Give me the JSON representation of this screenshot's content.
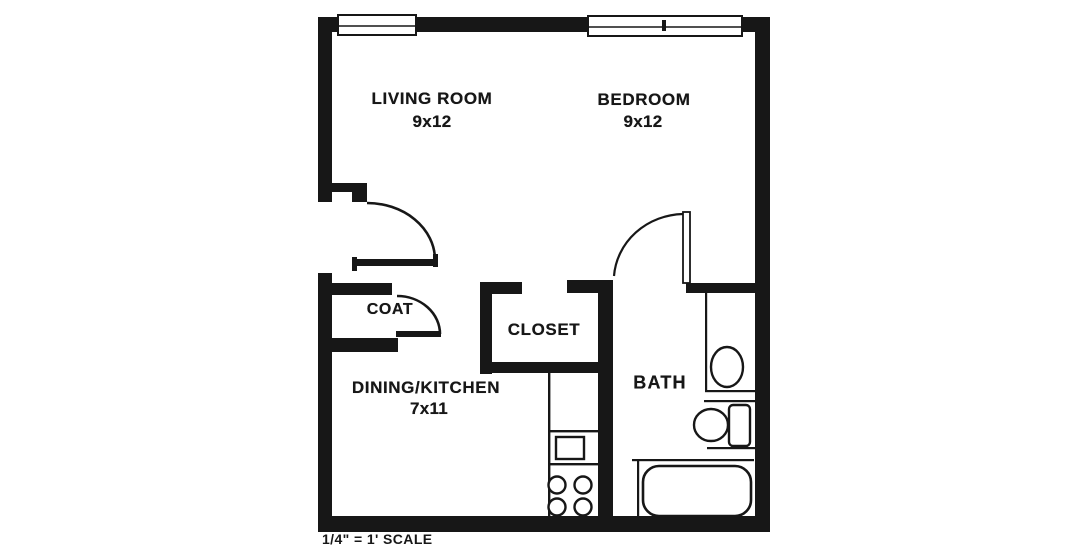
{
  "plan": {
    "type": "apartment-floor-plan",
    "rooms": {
      "living": {
        "name": "LIVING ROOM",
        "dim": "9x12"
      },
      "bedroom": {
        "name": "BEDROOM",
        "dim": "9x12"
      },
      "dining": {
        "name": "DINING/KITCHEN",
        "dim": "7x11"
      },
      "bath": {
        "name": "BATH"
      },
      "coat": {
        "name": "COAT"
      },
      "closet": {
        "name": "CLOSET"
      }
    },
    "scale_note": "1/4\" = 1' SCALE",
    "colors": {
      "ink": "#171717",
      "paper": "#ffffff"
    },
    "fixtures": [
      "window",
      "window-with-mullion-tick",
      "entry-door-swing",
      "coat-door-swing",
      "bath-door-swing",
      "kitchen-counter",
      "kitchen-sink",
      "range-4-burners",
      "vanity-sink",
      "toilet",
      "bathtub"
    ]
  }
}
